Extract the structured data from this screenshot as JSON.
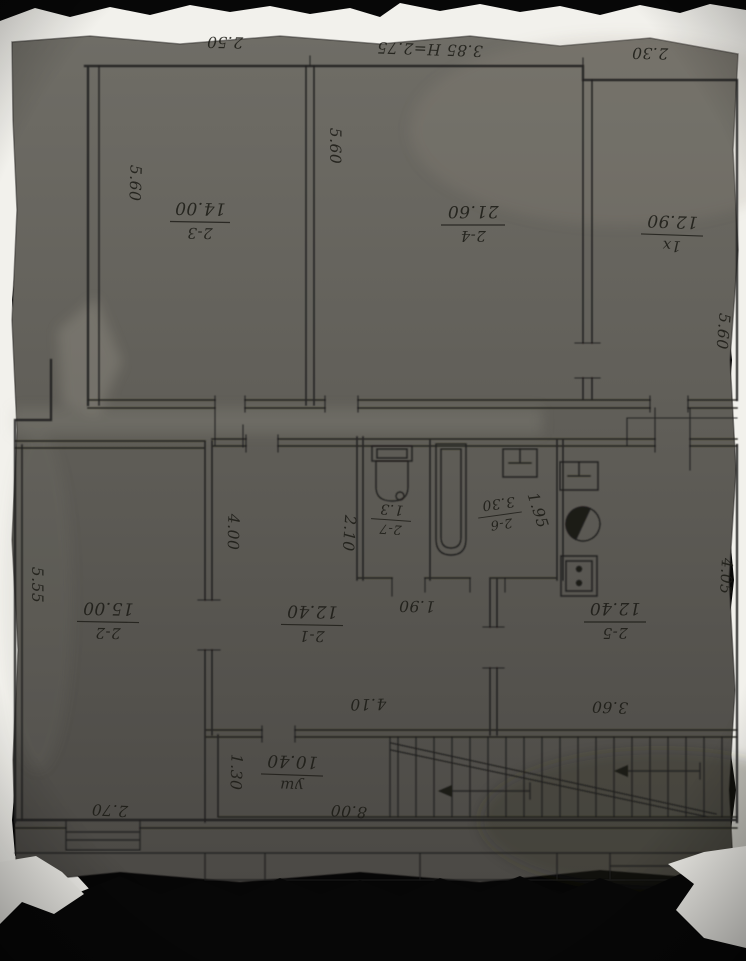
{
  "photo": {
    "background": "#050505",
    "backing_paper": "#f2f1ec",
    "plan_paper_light": "#6f6d66",
    "plan_paper_dark": "#4b4945",
    "ink": "#201f1c"
  },
  "rooms": [
    {
      "number": "2-3",
      "area": "14.00"
    },
    {
      "number": "2-4",
      "area": "21.60"
    },
    {
      "number": "1x",
      "area": "12.90"
    },
    {
      "number": "2-2",
      "area": "15.00"
    },
    {
      "number": "2-1",
      "area": "12.40"
    },
    {
      "number": "2-5",
      "area": "12.40"
    },
    {
      "number": "2-7",
      "area": "1.3"
    },
    {
      "number": "2-6",
      "area": "3.30"
    },
    {
      "number": "уш",
      "area": "10.40"
    }
  ],
  "dimensions": {
    "top_room_left_width": "2.50",
    "top_room_mid_width": "3.85 Н=2.75",
    "top_room_right_width": "2.30",
    "room23_depth": "5.60",
    "room24_depth": "5.60",
    "room1x_depth": "5.60",
    "room21_left": "4.00",
    "wc_wall": "2.10",
    "bath_width": "1.95",
    "bath_door": "1.90",
    "room21_width": "4.10",
    "kitchen_width": "3.60",
    "kitchen_depth": "4.05",
    "room22_depth": "5.55",
    "room22_width": "2.70",
    "hall_width": "1.30",
    "hall_length": "8.00"
  }
}
